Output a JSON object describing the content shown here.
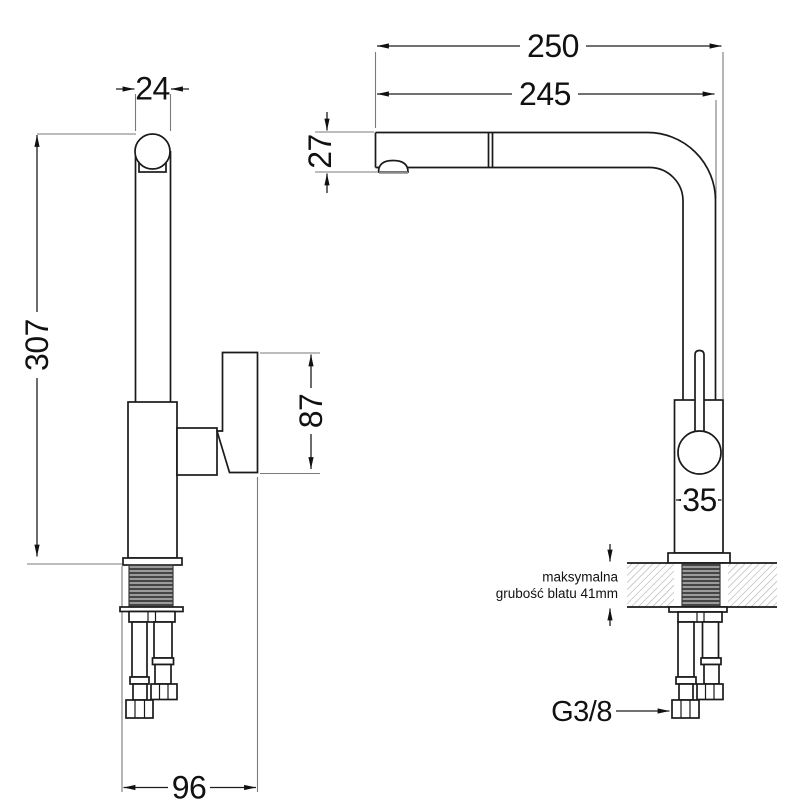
{
  "drawing_title": "pull-out kitchen faucet dimensional drawing",
  "colors": {
    "background": "#ffffff",
    "object_line": "#1a1a1a",
    "extension_line": "#7a7a7a",
    "hatch": "#b4b4b4",
    "thread_dark": "#454545",
    "thread_light": "#9b9b9b",
    "text": "#111111"
  },
  "side_view": {
    "labels": {
      "top_width": "24",
      "total_height": "307",
      "spray_head_height": "87",
      "base_width": "96"
    }
  },
  "front_view": {
    "labels": {
      "reach_total": "250",
      "reach": "245",
      "spout_height": "27",
      "body_width": "35"
    },
    "countertop_note": {
      "line1": "maksymalna",
      "line2": "grubość blatu 41mm"
    },
    "connection": "G3/8"
  }
}
